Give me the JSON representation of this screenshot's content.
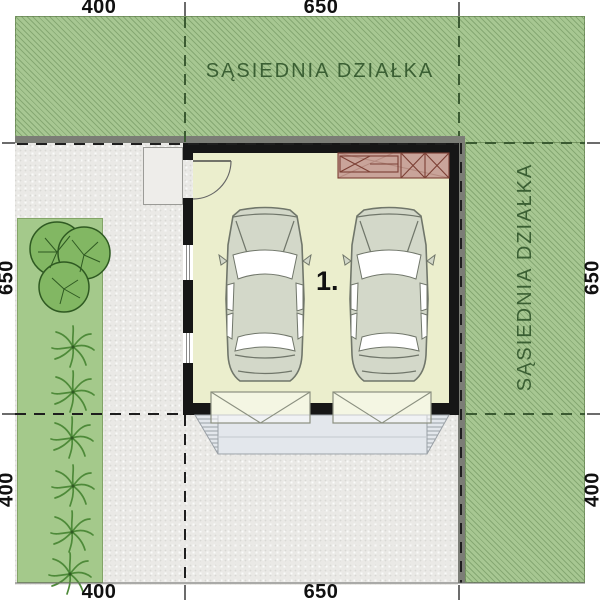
{
  "plan": {
    "neighbor_plot_label_top": "SĄSIEDNIA DZIAŁKA",
    "neighbor_plot_label_right": "SĄSIEDNIA DZIAŁKA",
    "room_label": "1."
  },
  "dimensions": {
    "top": [
      "400",
      "650"
    ],
    "bottom": [
      "400",
      "650"
    ],
    "left": [
      "650",
      "400"
    ],
    "right": [
      "650",
      "400"
    ]
  },
  "colors": {
    "neighbor_green": "#a7c792",
    "garden_green": "#a4c98b",
    "ground_gray": "#eae9e6",
    "floor_cream": "#ebeecd",
    "wall_black": "#161616",
    "workbench_rose": "#c9a49a",
    "apron_gray": "#e3e7ec",
    "label_green": "#3a5f33",
    "tree_green": "#82b763",
    "car_body": "#d3d8c9"
  }
}
